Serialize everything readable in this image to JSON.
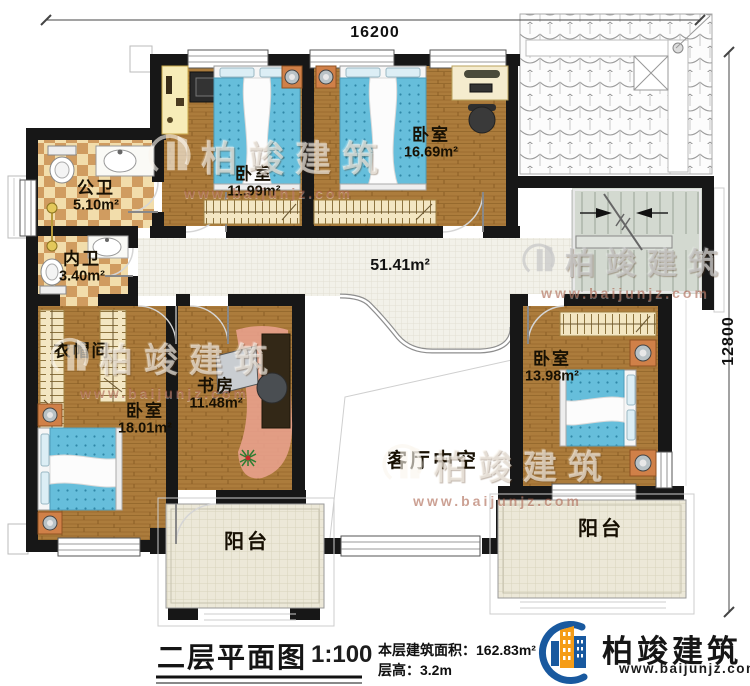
{
  "plan": {
    "dim_top": "16200",
    "dim_right": "12800",
    "hall_area": "51.41m²",
    "rooms": [
      {
        "name": "公卫",
        "area": "5.10m²"
      },
      {
        "name": "内卫",
        "area": "3.40m²"
      },
      {
        "name": "卧室",
        "area": "11.99m²"
      },
      {
        "name": "卧室",
        "area": "16.69m²"
      },
      {
        "name": "衣帽间",
        "area": ""
      },
      {
        "name": "卧室",
        "area": "18.01m²"
      },
      {
        "name": "书房",
        "area": "11.48m²"
      },
      {
        "name": "卧室",
        "area": "13.98m²"
      },
      {
        "name": "客厅中空",
        "area": ""
      },
      {
        "name": "阳台",
        "area": ""
      },
      {
        "name": "阳台",
        "area": ""
      }
    ]
  },
  "watermark": {
    "name": "柏竣建筑",
    "url": "www.baijunjz.com"
  },
  "footer": {
    "title": "二层平面图",
    "scale": "1:100",
    "area_label": "本层建筑面积：162.83m²",
    "height_label": "层高：3.2m"
  },
  "logo": {
    "name": "柏竣建筑",
    "url": "www.baijunjz.com"
  }
}
